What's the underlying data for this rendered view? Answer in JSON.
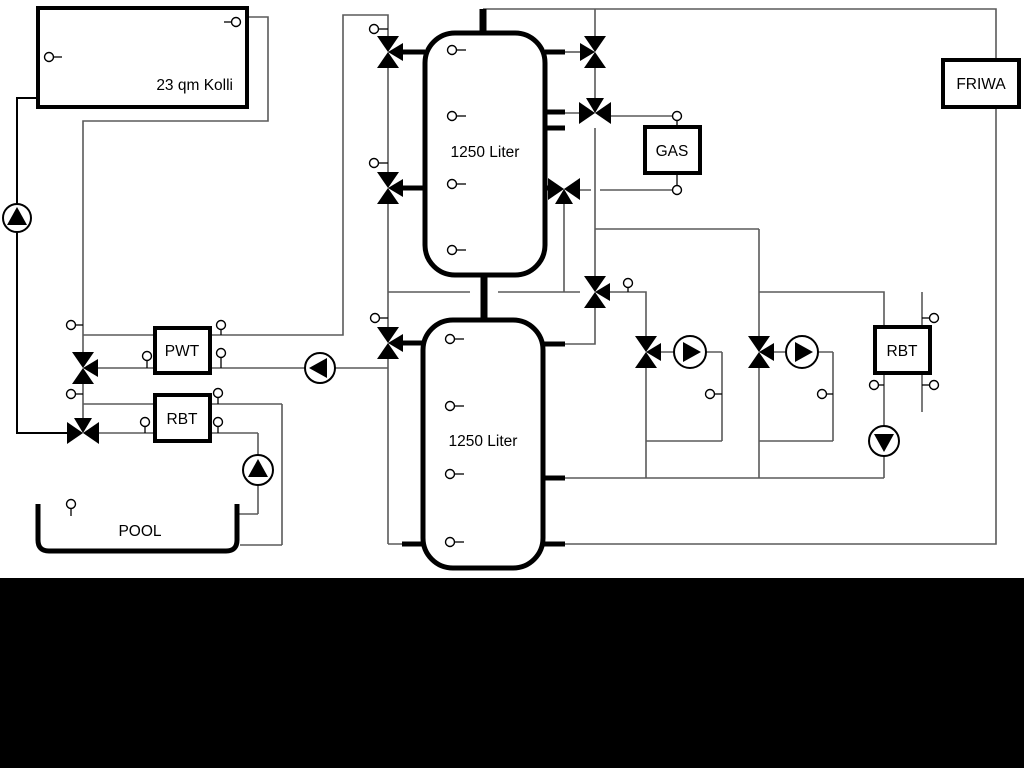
{
  "labels": {
    "collector": "23 qm Kolli",
    "tank_top": "1250 Liter",
    "tank_bottom": "1250 Liter",
    "gas": "GAS",
    "pwt": "PWT",
    "rbt": "RBT",
    "rbt_right": "RBT",
    "friwa": "FRIWA",
    "pool": "POOL"
  },
  "colors": {
    "background": "#ffffff",
    "pipe": "#5a5a5a",
    "component": "#000000",
    "footer_bar": "#000000"
  }
}
